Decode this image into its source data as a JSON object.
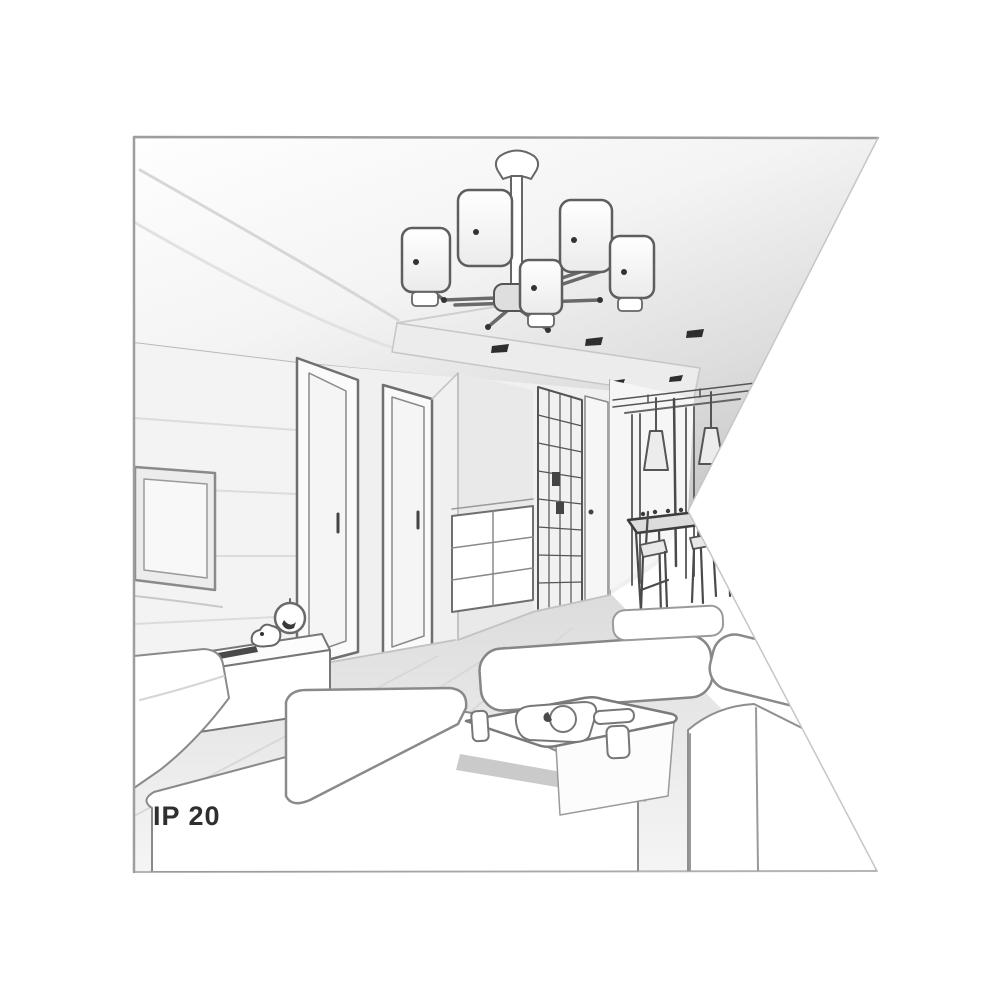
{
  "illustration": {
    "ip_rating_label": "IP 20"
  },
  "colors": {
    "frame_border": "#9e9e9e",
    "sketch_line": "#6f6f6f",
    "sketch_line_dark": "#3a3a3a",
    "wall_fill": "#f0f0f0",
    "ceiling_shade": "#c9c9c9",
    "floor_fill": "#e6e6e6",
    "furniture_fill": "#ffffff",
    "spotlight_dark": "#2e2e2e",
    "label_text": "#2f2f2f"
  }
}
